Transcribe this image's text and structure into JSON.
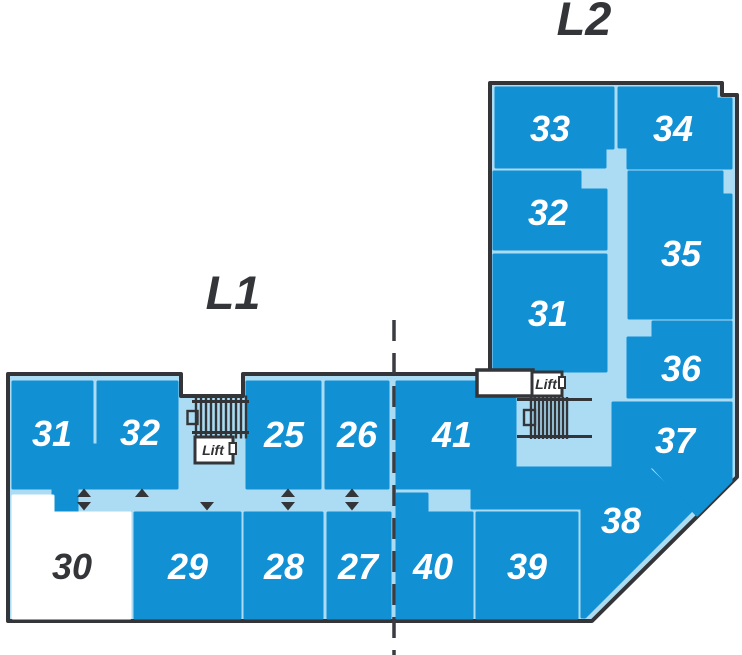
{
  "map_title": "Mall floor plan",
  "levels": [
    {
      "label": "L1",
      "lift_label": "Lift",
      "rooms": [
        {
          "number": "31"
        },
        {
          "number": "32"
        },
        {
          "number": "25"
        },
        {
          "number": "26"
        },
        {
          "number": "30",
          "variant": "light"
        },
        {
          "number": "29"
        },
        {
          "number": "28"
        },
        {
          "number": "27"
        }
      ]
    },
    {
      "label": "L2",
      "lift_label": "Lift",
      "rooms": [
        {
          "number": "33"
        },
        {
          "number": "34"
        },
        {
          "number": "32"
        },
        {
          "number": "31"
        },
        {
          "number": "35"
        },
        {
          "number": "36"
        },
        {
          "number": "37"
        },
        {
          "number": "41"
        },
        {
          "number": "40"
        },
        {
          "number": "39"
        },
        {
          "number": "38"
        }
      ]
    }
  ],
  "icons": {
    "stairs": "stairs-hatch-icon",
    "lift": "lift-box-icon",
    "arrow_up": "▲",
    "arrow_down": "▼",
    "divider": "dashed-line"
  },
  "colors": {
    "room_fill": "#1190d4",
    "corridor_fill": "#abdcf4",
    "outline": "#333538",
    "highlight_room_fill": "#ffffff",
    "room_label": "#ffffff",
    "dark_text": "#333538"
  }
}
